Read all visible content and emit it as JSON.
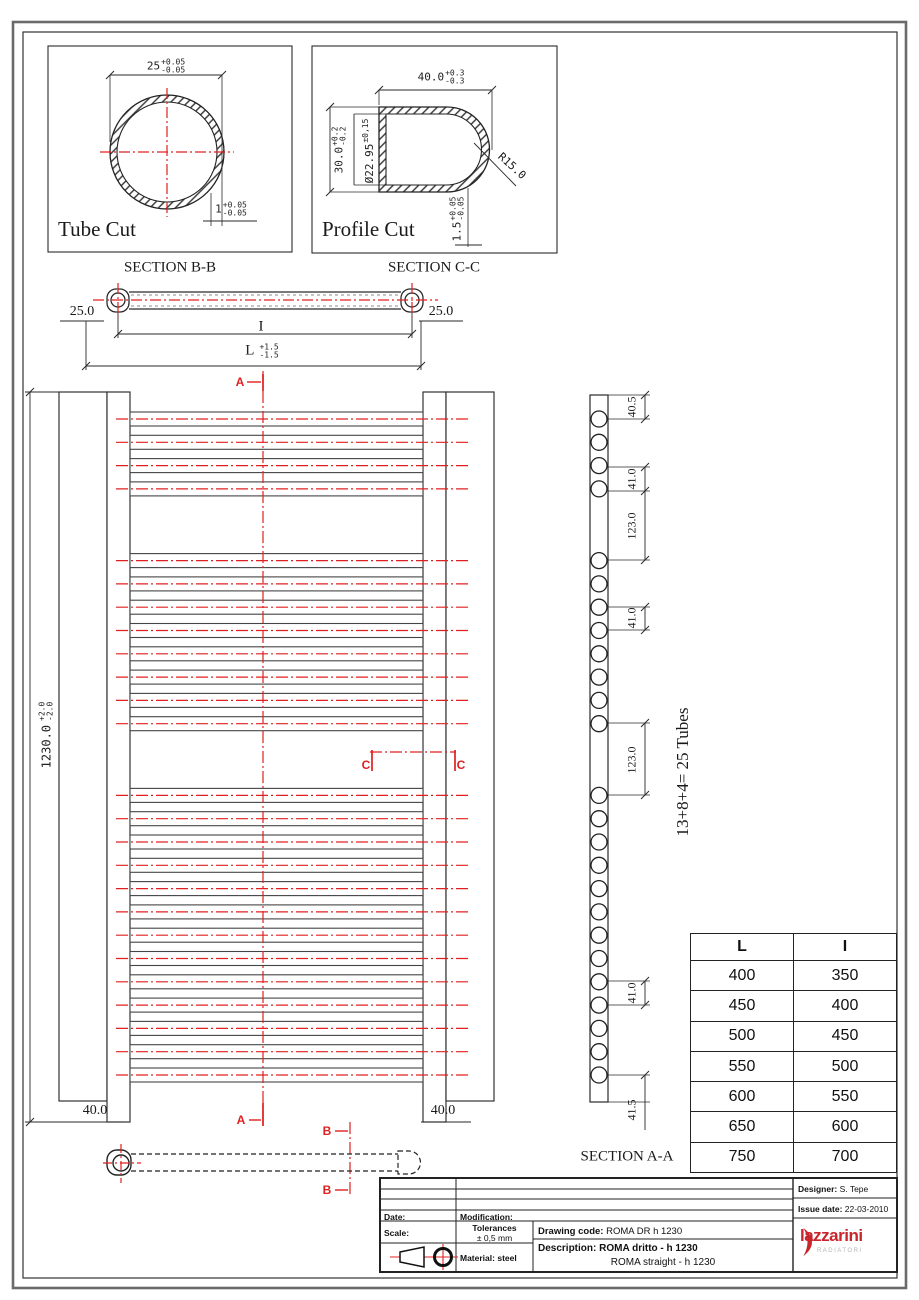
{
  "colors": {
    "red": "#e02020",
    "line": "#2a2a2a",
    "logo_red": "#c9252c"
  },
  "tube_cut": {
    "title": "Tube Cut",
    "section": "SECTION B-B",
    "dim_diameter": {
      "value": "25",
      "plus": "+0.05",
      "minus": "-0.05"
    },
    "dim_wall": {
      "value": "1",
      "plus": "+0.05",
      "minus": "-0.05"
    }
  },
  "profile_cut": {
    "title": "Profile Cut",
    "section": "SECTION C-C",
    "dim_width": {
      "value": "40.0",
      "plus": "+0.3",
      "minus": "-0.3"
    },
    "dim_height": {
      "value": "30.0",
      "plus": "+0.2",
      "minus": "-0.2"
    },
    "dim_inner": {
      "value": "Ø22.95",
      "tol": "±0,15"
    },
    "radius": "R15.0",
    "dim_wall": {
      "value": "1.5",
      "plus": "+0.05",
      "minus": "-0.05"
    }
  },
  "top_view": {
    "left_offset": "25.0",
    "right_offset": "25.0",
    "inner_label": "I",
    "length_label": "L",
    "length_plus": "+1.5",
    "length_minus": "-1.5"
  },
  "front_view": {
    "height": {
      "value": "1230.0",
      "plus": "+2.0",
      "minus": "-2.0"
    },
    "rail_width_left": "40.0",
    "rail_width_right": "40.0",
    "marker_a": "A",
    "marker_b": "B",
    "marker_c": "C"
  },
  "section_aa": {
    "label": "SECTION A-A",
    "note": "13+8+4= 25 Tubes",
    "tube_groups": [
      4,
      8,
      13
    ],
    "dims": [
      "40.5",
      "41.0",
      "123.0",
      "41.0",
      "123.0",
      "41.0",
      "41.5"
    ]
  },
  "size_table": {
    "headers": [
      "L",
      "I"
    ],
    "rows": [
      [
        "400",
        "350"
      ],
      [
        "450",
        "400"
      ],
      [
        "500",
        "450"
      ],
      [
        "550",
        "500"
      ],
      [
        "600",
        "550"
      ],
      [
        "650",
        "600"
      ],
      [
        "750",
        "700"
      ]
    ]
  },
  "title_block": {
    "date_label": "Date:",
    "modification_label": "Modification:",
    "scale_label": "Scale:",
    "tolerances_label": "Tolerances",
    "tolerances_value": "± 0,5 mm",
    "material_label": "Material:",
    "material_value": "steel",
    "drawing_code_label": "Drawing code:",
    "drawing_code_value": "ROMA DR h 1230",
    "description_label": "Description:",
    "description_value": "ROMA dritto - h 1230",
    "description_alt": "ROMA straight - h 1230",
    "designer_label": "Designer:",
    "designer_value": "S. Tepe",
    "issue_label": "Issue date:",
    "issue_value": "22-03-2010",
    "logo_text": "lazzarini",
    "logo_subtext": "RADIATORI"
  }
}
